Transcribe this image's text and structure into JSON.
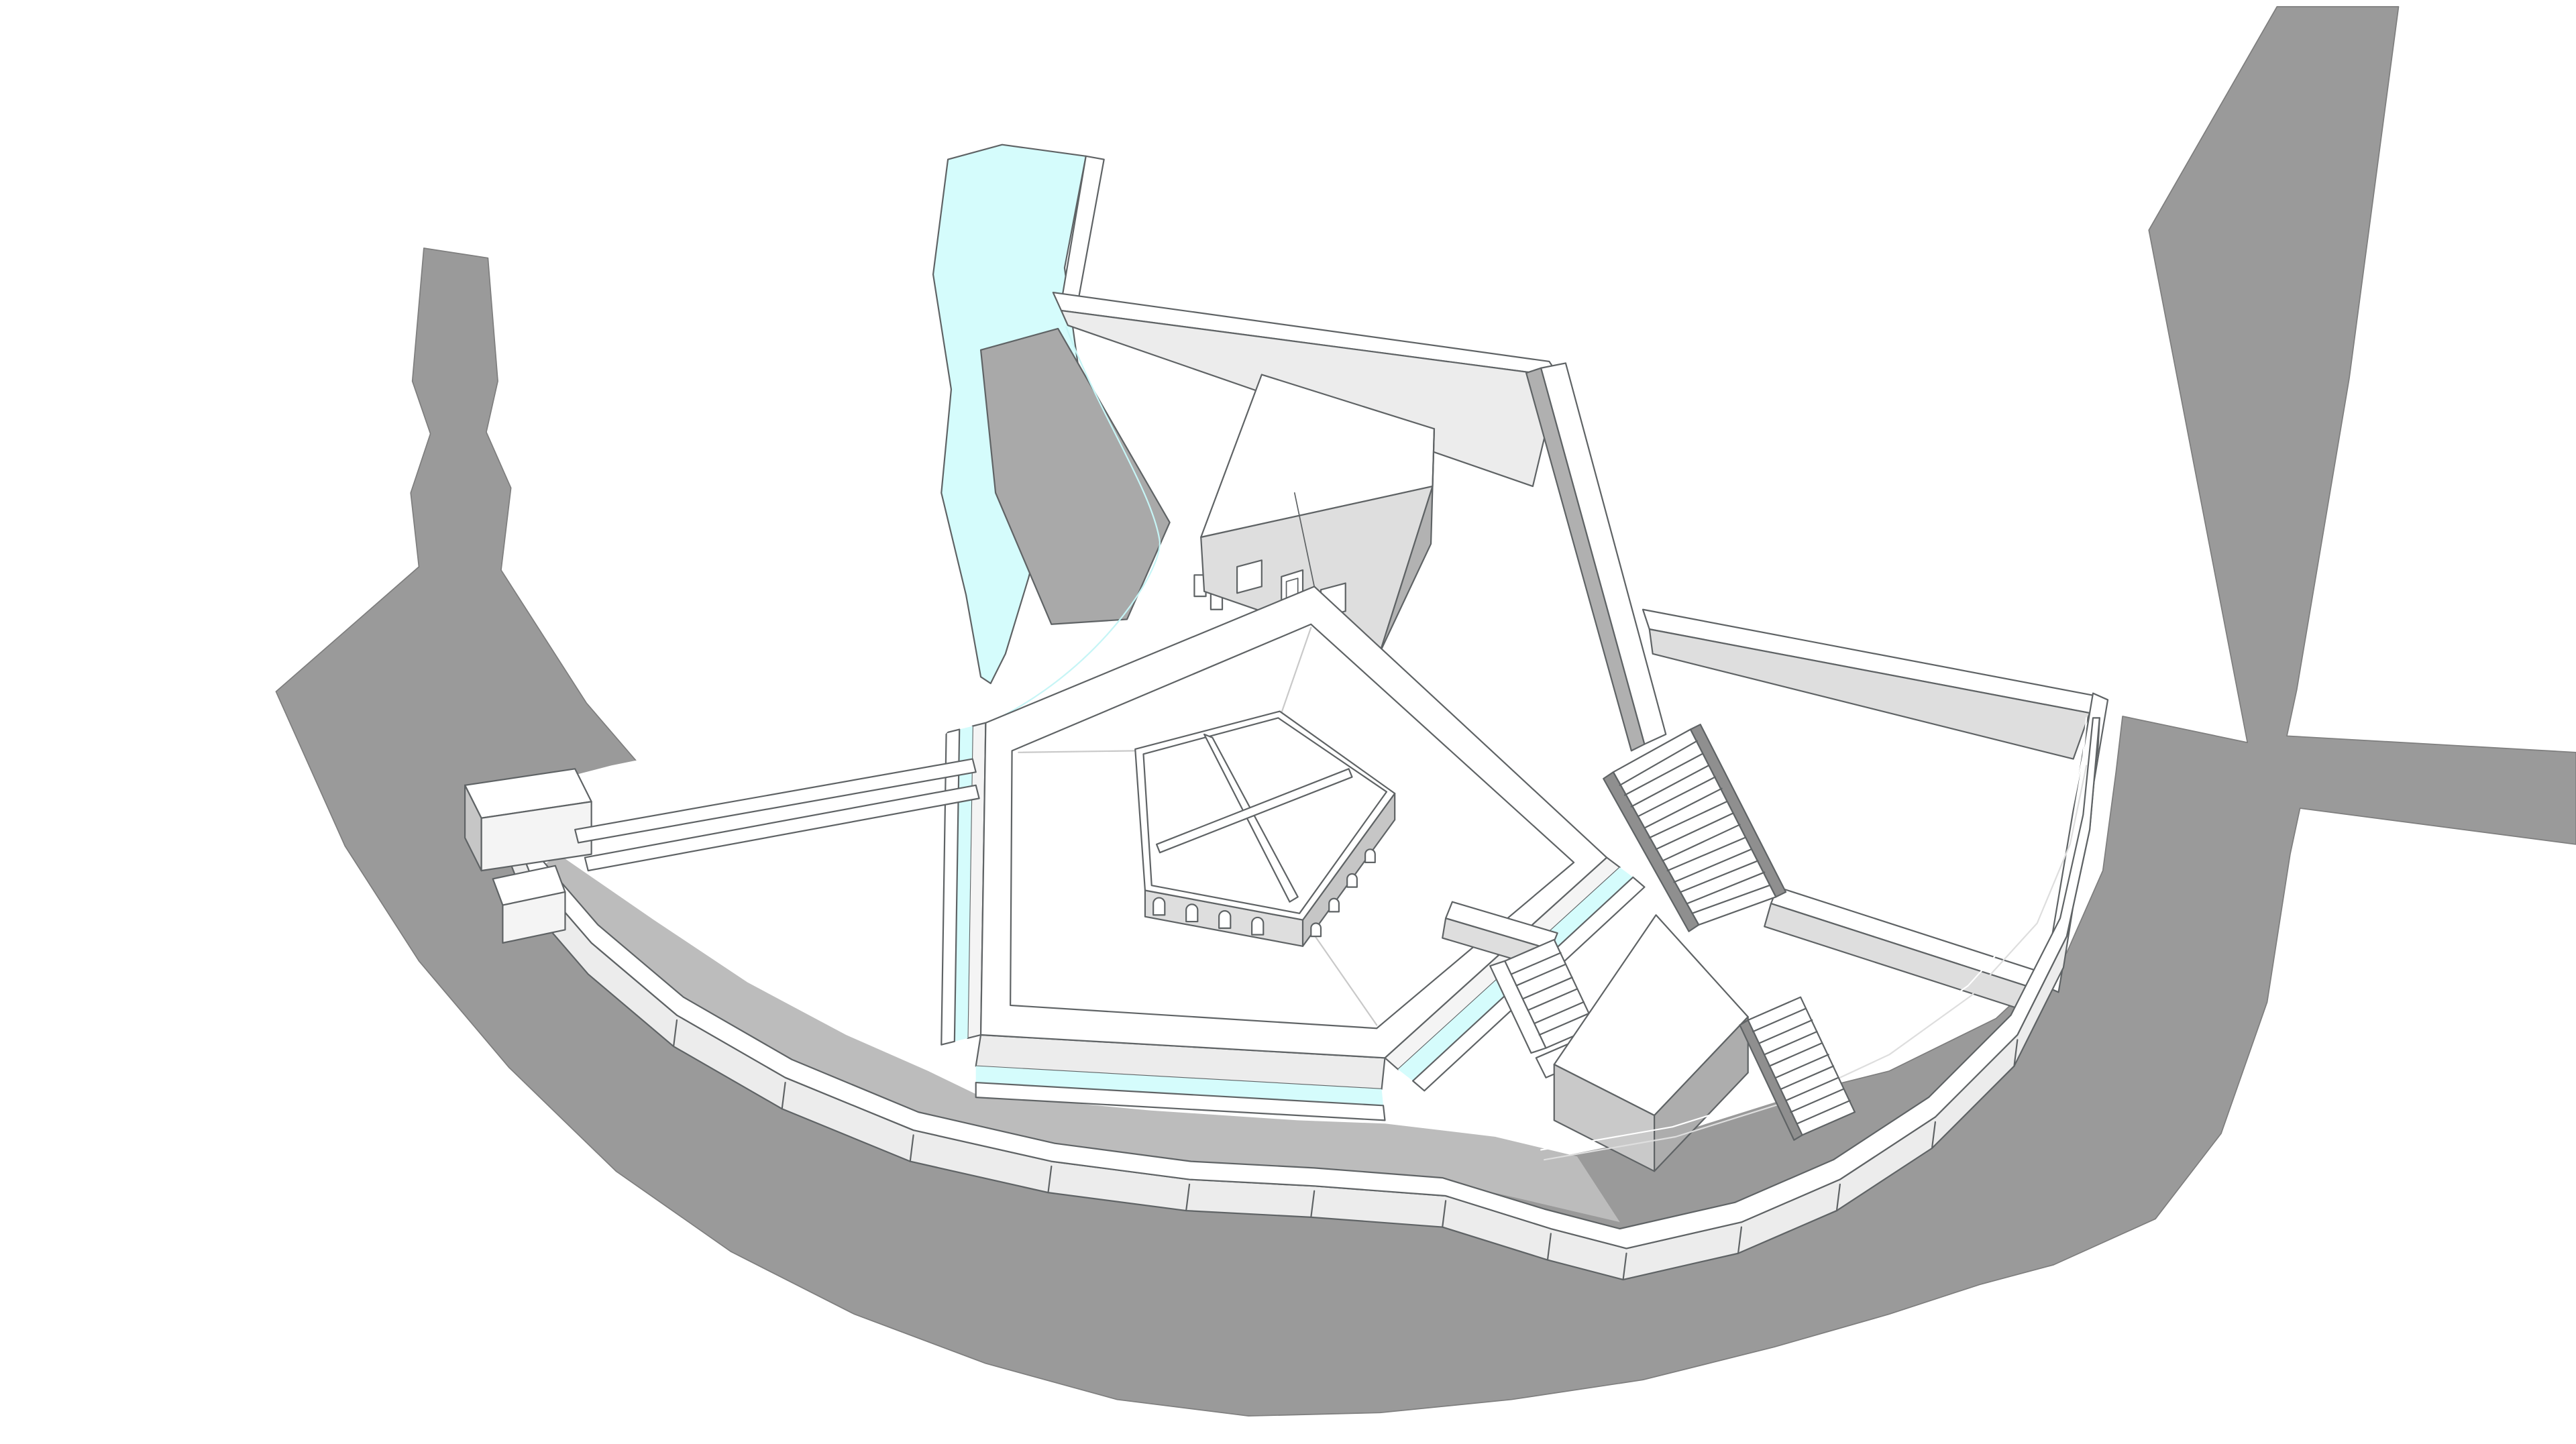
{
  "title": "Axonometric 3D site model — pentagonal fortress with moat and river",
  "colors": {
    "background": "#ffffff",
    "terrain": "#9a9a9a",
    "terrain_edge": "#7e7e7e",
    "shadow": "#bcbcbc",
    "water": "#d5fcfc",
    "water_deep": "#c6f5f6",
    "ramp": "#a9a9a9",
    "white": "#ffffff",
    "near_white": "#f4f4f4",
    "wall_face_light": "#ececec",
    "wall_face": "#dedede",
    "wall_face_mid": "#d2d2d2",
    "wall_face_dark": "#c6c6c6",
    "wall_face_darker": "#b0b0b0",
    "cube_left": "#c9c9c9",
    "cube_right": "#adadad",
    "house_side": "#b2b2b2",
    "stringer": "#8f8f8f",
    "edge": "#5f6365",
    "faint_line": "#c9c9c9"
  },
  "scene": {
    "description": "Monochrome architectural massing model viewed from above: a pentagonal walled platform with an inner pentagonal arcaded building, surrounded by a cyan moat fed by a river from the north, an outer curved rampart wall, a gatehouse bridge on the west, a small house on the north wall, a raised terrace with a grand staircase on the east, a cubic pavilion with two small stairs on the south-east, all set on a gray terrain apron.",
    "objects": [
      {
        "label": "terrain apron"
      },
      {
        "label": "river"
      },
      {
        "label": "access ramp"
      },
      {
        "label": "moat channel"
      },
      {
        "label": "north rampart wall"
      },
      {
        "label": "house with door, two windows and steps"
      },
      {
        "label": "east terrace"
      },
      {
        "label": "grand staircase (14 steps)"
      },
      {
        "label": "outer curved rampart"
      },
      {
        "label": "pentagonal platform with parapet"
      },
      {
        "label": "inner pentagonal arcaded building with crossed roof beams"
      },
      {
        "label": "cubic pavilion"
      },
      {
        "label": "small staircase south"
      },
      {
        "label": "small staircase east of pavilion"
      },
      {
        "label": "west gatehouse with bridge beams"
      }
    ]
  }
}
